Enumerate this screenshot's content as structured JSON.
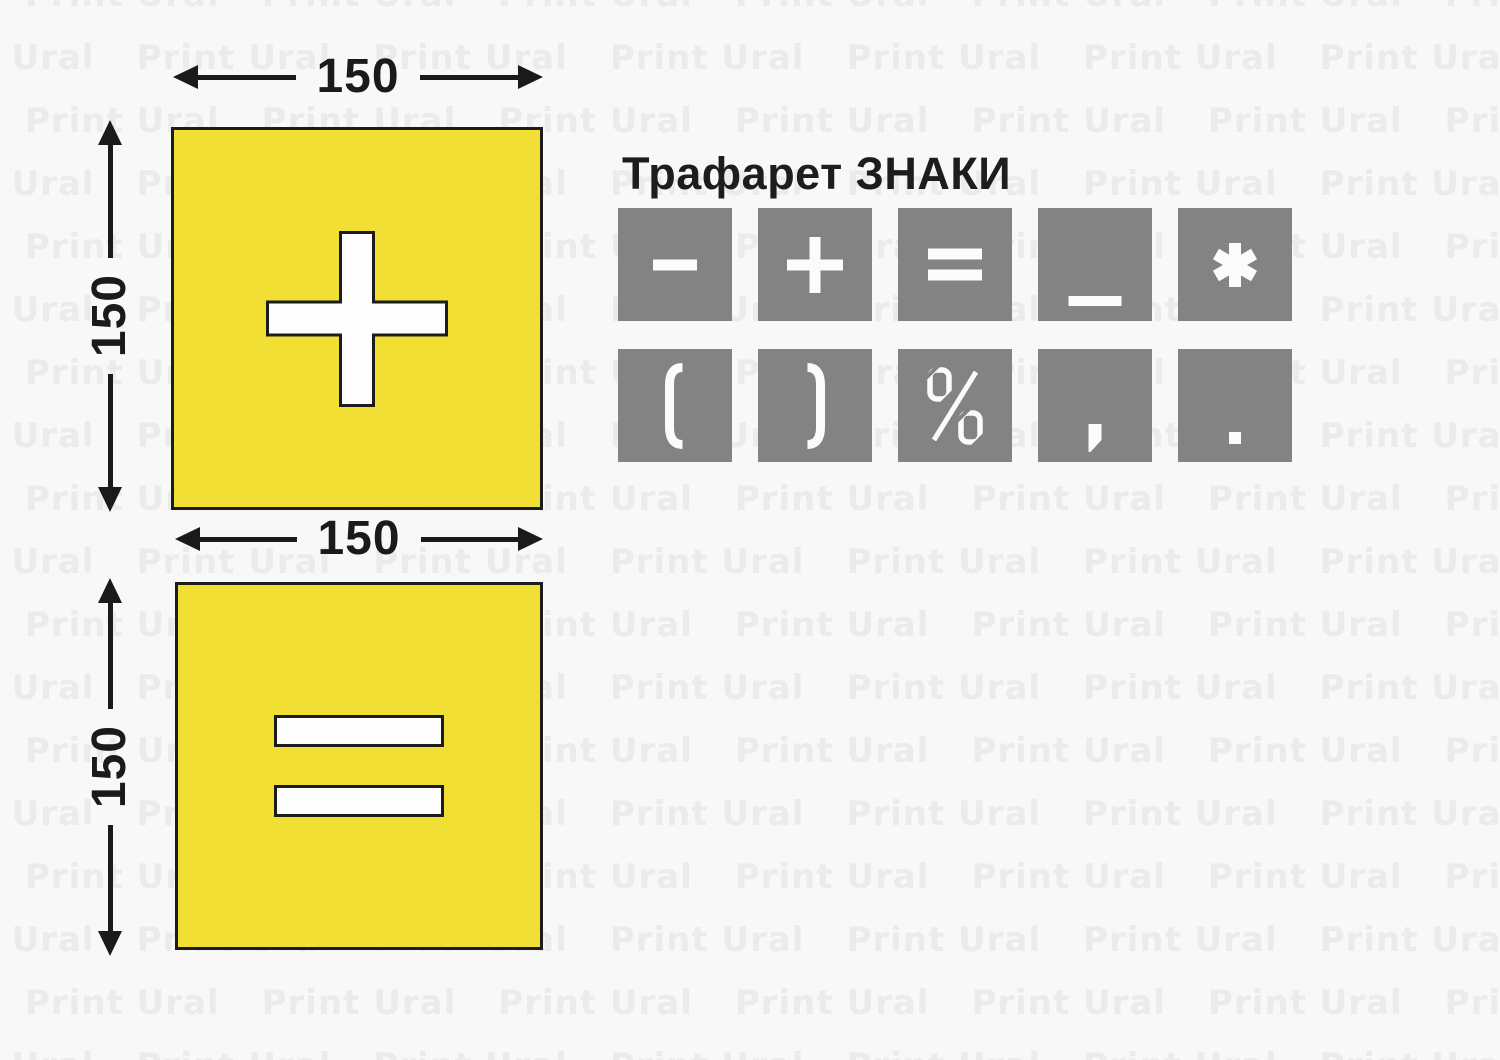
{
  "title": "Трафарет ЗНАКИ",
  "watermark": {
    "text": "Print Ural"
  },
  "colors": {
    "background": "#f8f8f8",
    "watermark_text": "#ebebeb",
    "stencil_yellow": "#f1df33",
    "outline_black": "#1c1c1c",
    "tile_gray": "#838383",
    "symbol_white": "#fbfbfb",
    "dimension_ink": "#1a1a1a"
  },
  "stencils": [
    {
      "name": "plus-stencil",
      "symbol": "plus",
      "width_label": "150",
      "height_label": "150"
    },
    {
      "name": "equals-stencil",
      "symbol": "equals",
      "width_label": "150",
      "height_label": "150"
    }
  ],
  "signs_panel": {
    "tiles": [
      {
        "symbol": "minus"
      },
      {
        "symbol": "plus"
      },
      {
        "symbol": "equals"
      },
      {
        "symbol": "underscore"
      },
      {
        "symbol": "asterisk"
      },
      {
        "symbol": "parenthesis-open"
      },
      {
        "symbol": "parenthesis-close"
      },
      {
        "symbol": "percent"
      },
      {
        "symbol": "comma"
      },
      {
        "symbol": "period"
      }
    ]
  }
}
